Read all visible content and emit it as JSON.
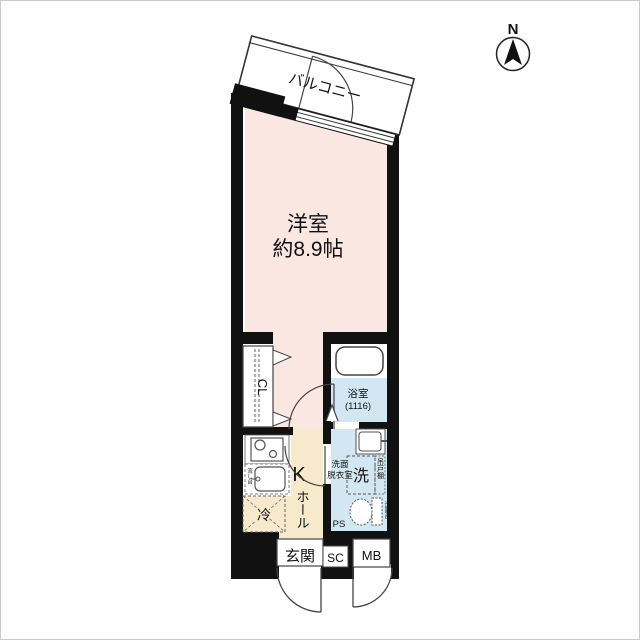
{
  "compass": {
    "label": "N"
  },
  "plan": {
    "balcony": {
      "label": "バルコニー"
    },
    "room": {
      "name": "洋室",
      "size": "約8.9帖"
    },
    "closet": {
      "label": "CL"
    },
    "bath": {
      "name": "浴室",
      "size": "(1116)"
    },
    "kitchen": {
      "label": "K",
      "sink_label": "流し台"
    },
    "hall": {
      "label": "ホール"
    },
    "wash": {
      "line1": "洗面",
      "line2": "脱衣室",
      "washer": "洗",
      "cupboard": "吊戸棚",
      "vanity": "洗面台",
      "pipe_space": "PS"
    },
    "fridge": {
      "label": "冷"
    },
    "entrance": {
      "label": "玄関"
    },
    "shoe": {
      "label": "SC"
    },
    "meter": {
      "label": "MB"
    }
  },
  "colors": {
    "room": "#fbe7e1",
    "hall": "#f6e9cc",
    "water": "#d3e7f2",
    "fridge_bg": "#f6e9cc",
    "wall": "#111111",
    "line": "#444444"
  }
}
